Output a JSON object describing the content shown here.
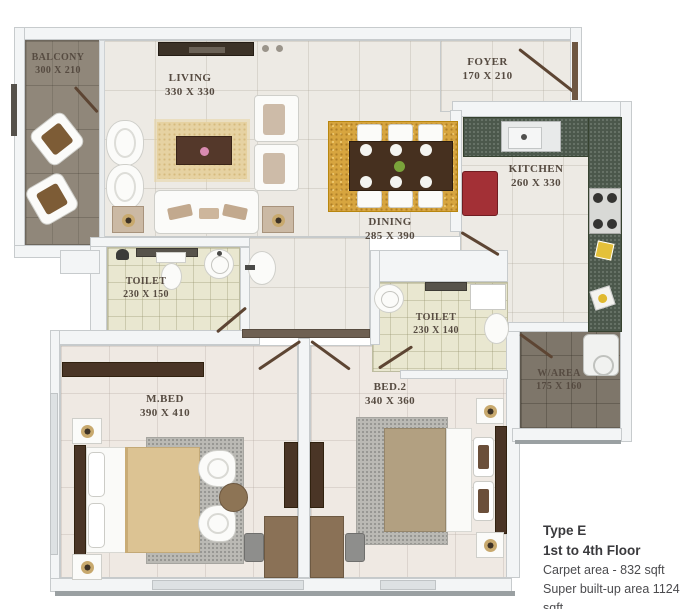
{
  "rooms": {
    "balcony": {
      "name": "BALCONY",
      "size": "300 X 210"
    },
    "living": {
      "name": "LIVING",
      "size": "330 X 330"
    },
    "foyer": {
      "name": "FOYER",
      "size": "170 X 210"
    },
    "dining": {
      "name": "DINING",
      "size": "285 X 390"
    },
    "kitchen": {
      "name": "KITCHEN",
      "size": "260 X 330"
    },
    "toilet_1": {
      "name": "TOILET",
      "size": "230 X 150"
    },
    "toilet_2": {
      "name": "TOILET",
      "size": "230 X 140"
    },
    "master_bedroom": {
      "name": "M.BED",
      "size": "390 X 410"
    },
    "bedroom_2": {
      "name": "BED.2",
      "size": "340 X 360"
    },
    "wash_area": {
      "name": "W/AREA",
      "size": "175 X 160"
    }
  },
  "info": {
    "type": "Type E",
    "floor": "1st to 4th Floor",
    "carpet_area": "Carpet area - 832 sqft",
    "super_area": "Super built-up area 1124 sqft"
  },
  "colors": {
    "floor_tile": "#edeae4",
    "balcony_wood": "#90877a",
    "toilet_tile": "#e9e7d0",
    "wash_area_tile": "#7e766a",
    "kitchen_counter": "#4b584b",
    "fridge_red": "#a33036",
    "dining_rug": "#d7a53f",
    "living_rug": "#e6d2a2",
    "bedroom_rug": "#bab9b4",
    "dark_wood": "#4a3526",
    "bed_blanket_master": "#dcc393",
    "bed_blanket_bed2": "#b2a081",
    "label_text": "#564b41",
    "info_text": "#414144"
  }
}
